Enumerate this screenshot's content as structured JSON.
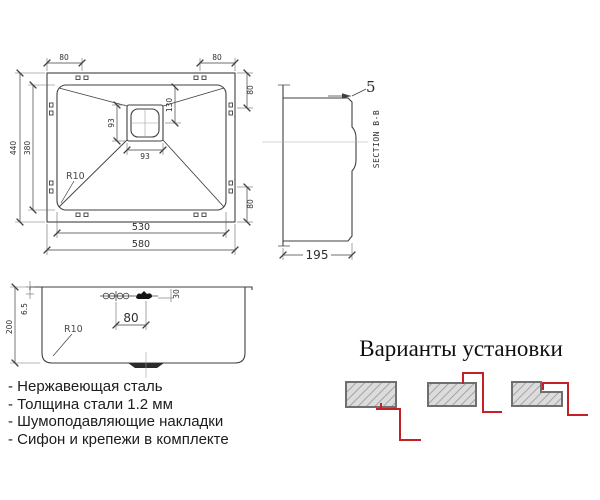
{
  "plan": {
    "dim_top_left": "80",
    "dim_top_right": "80",
    "dim_outer_height": "440",
    "dim_inner_height": "380",
    "dim_inner_width": "530",
    "dim_outer_width": "580",
    "dim_right_top": "80",
    "dim_right_bottom": "80",
    "dim_drain_width": "93",
    "dim_drain_height": "93",
    "dim_drain_offset": "130",
    "corner_radius": "R10"
  },
  "section": {
    "label": "SECTION B-B",
    "dim_rim": "5",
    "dim_depth": "195"
  },
  "front": {
    "dim_height": "200",
    "dim_rim_height": "6.5",
    "corner_radius": "R10",
    "dim_hole_spacing": "80",
    "dim_overflow": "30"
  },
  "features": {
    "items": [
      "- Нержавеющая сталь",
      "- Толщина стали 1.2 мм",
      "- Шумоподавляющие накладки",
      "- Сифон и крепежи в комплекте"
    ]
  },
  "installation": {
    "title": "Варианты установки"
  },
  "colors": {
    "line": "#3f3f3f",
    "accent_red": "#c52026",
    "hatch_fill": "#dcdcdc",
    "hatch_stroke": "#9a9a9a"
  }
}
